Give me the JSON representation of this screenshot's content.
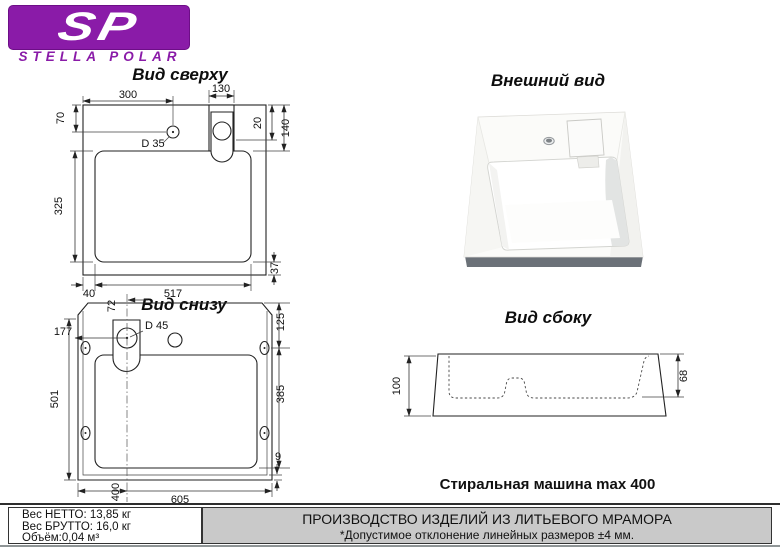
{
  "logo": {
    "monogram": "SP",
    "brand": "STELLA POLAR"
  },
  "colors": {
    "brand_purple": "#8A1BA8",
    "footer_gray": "#C9C9C9"
  },
  "views": {
    "top": {
      "title": "Вид сверху",
      "dims": {
        "w300": "300",
        "w130": "130",
        "h70": "70",
        "h20": "20",
        "h140": "140",
        "hole": "D 35",
        "h325": "325",
        "w517": "517",
        "w40": "40",
        "h37": "37"
      }
    },
    "bottom": {
      "title": "Вид снизу",
      "dims": {
        "w72": "72",
        "hole": "D 45",
        "w177": "177",
        "h125": "125",
        "h385": "385",
        "h501": "501",
        "h9": "9",
        "w400": "400",
        "w605": "605"
      }
    },
    "external": {
      "title": "Внешний вид"
    },
    "side": {
      "title": "Вид сбоку",
      "dims": {
        "h100": "100",
        "h68": "68"
      }
    }
  },
  "notes": {
    "washer": "Стиральная машина max 400"
  },
  "footer": {
    "net_weight": "Вес НЕТТО: 13,85 кг",
    "gross_weight": "Вес БРУТТО: 16,0 кг",
    "volume": "Объём:0,04 м³",
    "production": "ПРОИЗВОДСТВО ИЗДЕЛИЙ ИЗ ЛИТЬЕВОГО МРАМОРА",
    "tolerance": "*Допустимое отклонение линейных размеров ±4 мм."
  }
}
